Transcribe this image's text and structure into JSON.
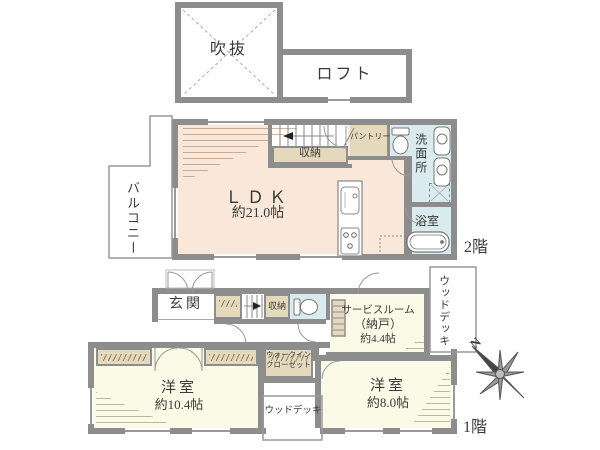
{
  "colors": {
    "wall": "#8d8d8d",
    "ldk_fill": "#f9e8da",
    "wet_fill": "#d9ebee",
    "closet_fill": "#e4d9bd",
    "room_fill": "#fbfae6",
    "thin_line": "#9a9a9a"
  },
  "loft": {
    "void_label": "吹抜",
    "loft_label": "ロフト"
  },
  "second_floor": {
    "balcony": "バルコニー",
    "ldk": "ＬＤＫ",
    "ldk_size": "約21.0帖",
    "storage": "収納",
    "pantry": "パントリー",
    "washroom": "洗面所",
    "bathroom": "浴室",
    "floor_label": "2階"
  },
  "first_floor": {
    "entrance": "玄関",
    "storage": "収納",
    "service_room": "サービスルーム",
    "service_room_alt": "（納戸）",
    "service_room_size": "約4.4帖",
    "wood_deck_side": "ウッドデッキ",
    "wic_line1": "ウォークイン",
    "wic_line2": "クローゼット",
    "bedroom_a": "洋室",
    "bedroom_a_size": "約10.4帖",
    "bedroom_b": "洋室",
    "bedroom_b_size": "約8.0帖",
    "wood_deck_bottom": "ウッドデッキ",
    "floor_label": "1階",
    "compass_north": "N"
  }
}
